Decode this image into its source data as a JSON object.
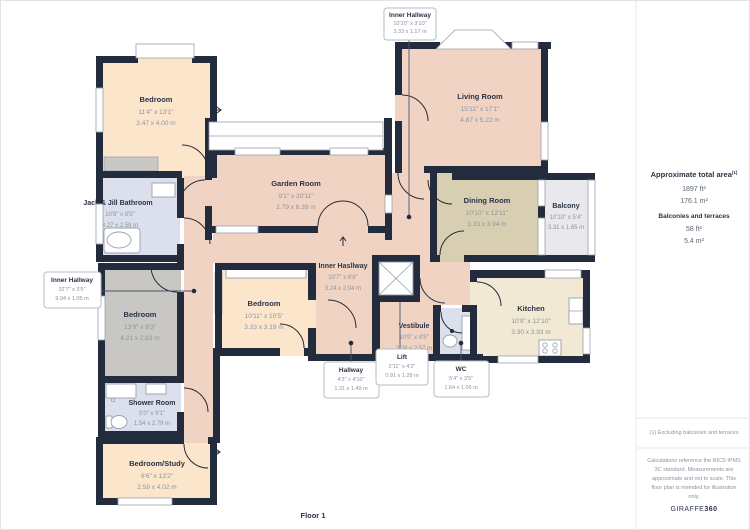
{
  "floor": {
    "label": "Floor 1"
  },
  "rooms": {
    "bedroom_tl": {
      "name": "Bedroom",
      "imperial": "11'4\" x 13'1\"",
      "metric": "3.47 x 4.00 m"
    },
    "jack_jill": {
      "name": "Jack & Jill Bathroom",
      "imperial": "10'8\" x 8'5\"",
      "metric": "3.27 x 2.58 m"
    },
    "garden_room": {
      "name": "Garden Room",
      "imperial": "9'1\" x 20'11\"",
      "metric": "2.79 x 6.39 m"
    },
    "living_room": {
      "name": "Living Room",
      "imperial": "15'11\" x 17'1\"",
      "metric": "4.87 x 5.22 m"
    },
    "dining_room": {
      "name": "Dining Room",
      "imperial": "10'10\" x 12'11\"",
      "metric": "3.33 x 3.94 m"
    },
    "balcony": {
      "name": "Balcony",
      "imperial": "10'10\" x 5'4\"",
      "metric": "3.31 x 1.65 m"
    },
    "kitchen": {
      "name": "Kitchen",
      "imperial": "10'9\" x 12'10\"",
      "metric": "3.30 x 3.93 m"
    },
    "bedroom_left": {
      "name": "Bedroom",
      "imperial": "13'9\" x 9'3\"",
      "metric": "4.21 x 2.83 m"
    },
    "bedroom_center": {
      "name": "Bedroom",
      "imperial": "10'11\" x 10'5\"",
      "metric": "3.33 x 3.19 m"
    },
    "inner_hall_mid": {
      "name": "Inner Hasllway",
      "imperial": "10'7\" x 6'8\"",
      "metric": "3.24 x 2.04 m"
    },
    "vestibule": {
      "name": "Vestibule",
      "imperial": "10'9\" x 8'5\"",
      "metric": "3.28 x 2.57 m"
    },
    "shower_room": {
      "name": "Shower Room",
      "imperial": "5'0\" x 9'1\"",
      "metric": "1.54 x 2.79 m"
    },
    "bedroom_study": {
      "name": "Bedroom/Study",
      "imperial": "8'6\" x 13'2\"",
      "metric": "2.59 x 4.02 m"
    },
    "inner_hall_top": {
      "name": "Inner Hallway",
      "imperial": "10'10\" x 3'10\"",
      "metric": "3.33 x 1.17 m"
    },
    "inner_hall_left": {
      "name": "Inner Hallway",
      "imperial": "32'7\" x 3'5\"",
      "metric": "9.94 x 1.05 m"
    },
    "hallway": {
      "name": "Hallway",
      "imperial": "4'3\" x 4'10\"",
      "metric": "1.31 x 1.49 m"
    },
    "lift": {
      "name": "Lift",
      "imperial": "2'11\" x 4'2\"",
      "metric": "0.91 x 1.28 m"
    },
    "wc": {
      "name": "WC",
      "imperial": "5'4\" x 3'5\"",
      "metric": "1.64 x 1.06 m"
    }
  },
  "panel": {
    "total_area_label": "Approximate total area",
    "total_area_sup": "(1)",
    "total_ft": "1897 ft²",
    "total_m": "176.1 m²",
    "balconies_label": "Balconies and terraces",
    "balcony_ft": "58 ft²",
    "balcony_m": "5.4 m²",
    "footnote": "(1) Excluding balconies and terraces",
    "disclaimer_lines": [
      "Calculations reference the RICS IPMS",
      "3C standard. Measurements are",
      "approximate and not to scale. This",
      "floor plan is intended for illustration",
      "only."
    ],
    "brand_giraffe": "GIRAFFE",
    "brand_360": "360"
  },
  "colors": {
    "wall": "#232c3c",
    "room_salmon": "#f1d3c3",
    "room_cream": "#fbe6cc",
    "room_khaki": "#d8cfb3",
    "room_kitchen": "#f2e9d5",
    "room_gray": "#c8c7c4",
    "room_blue": "#dbe0ec",
    "balcony_gray": "#e9e9ed",
    "label_dark": "#2a3446",
    "label_gray": "#8d93a0"
  }
}
